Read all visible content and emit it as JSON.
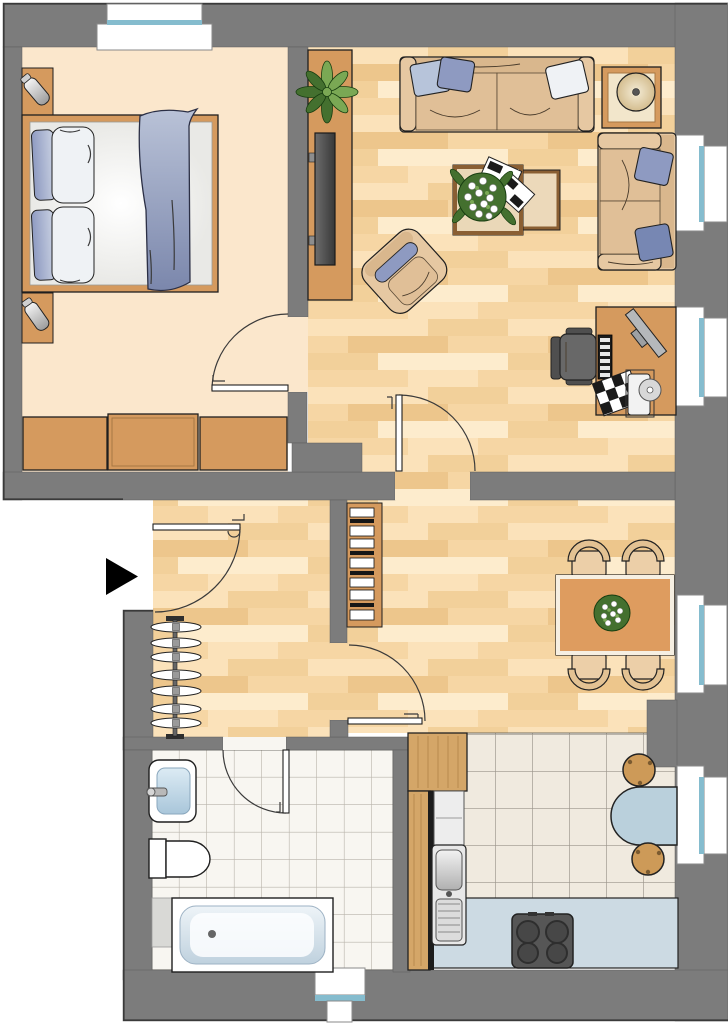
{
  "plan": {
    "type": "apartment-floor-plan",
    "rooms": [
      {
        "id": "bedroom",
        "position": "top-left",
        "floor": "plain-cream",
        "furniture": [
          "double-bed",
          "blue-pillows",
          "white-pillows",
          "blue-blanket",
          "nightstand-top",
          "nightstand-bottom",
          "table-lamp-top",
          "table-lamp-bottom",
          "wardrobe-three-sections"
        ],
        "windows": [
          "top-wall-window"
        ],
        "doors": [
          "door-to-hallway-corridor"
        ]
      },
      {
        "id": "living-room",
        "position": "top-right",
        "floor": "wood-parquet",
        "furniture": [
          "sideboard",
          "potted-plant",
          "tv",
          "three-seat-sofa",
          "sofa-pillows",
          "side-table-with-lamp",
          "two-seat-sofa",
          "coffee-table-pair",
          "flower-bouquet",
          "magazines",
          "armchair",
          "desk",
          "monitor",
          "keyboard",
          "checkered-notebook",
          "printer-with-cd",
          "office-chair"
        ],
        "windows": [
          "right-wall-window-upper",
          "right-wall-window-lower"
        ],
        "doors": [
          "door-to-hallway"
        ]
      },
      {
        "id": "hallway",
        "position": "middle-left",
        "floor": "wood-parquet",
        "furniture": [
          "coat-rack",
          "shelf-unit"
        ],
        "doors": [
          "entrance-door",
          "door-to-kitchen-corridor"
        ]
      },
      {
        "id": "dining-area",
        "position": "middle-right",
        "floor": "wood-parquet",
        "furniture": [
          "dining-table",
          "dining-chairs-4",
          "flower-centerpiece"
        ],
        "windows": [
          "right-wall-window"
        ]
      },
      {
        "id": "bathroom",
        "position": "bottom-left",
        "floor": "white-tiles",
        "furniture": [
          "washbasin",
          "faucet",
          "toilet",
          "bathtub"
        ],
        "windows": [
          "bottom-wall-window"
        ],
        "doors": [
          "bathroom-door"
        ]
      },
      {
        "id": "kitchen",
        "position": "bottom-right",
        "floor": "cream-tiles",
        "furniture": [
          "tall-cabinet",
          "counter-run",
          "double-sink",
          "lower-counter",
          "stove-four-burners",
          "wall-mounted-table",
          "stool-top",
          "stool-bottom"
        ],
        "windows": [
          "right-wall-window"
        ]
      }
    ],
    "doors_total": 5,
    "windows_total": 6,
    "entrance": {
      "marker": "black-arrow-icon",
      "side": "left",
      "direction": "pointing-right"
    }
  },
  "colors": {
    "page": "#ffffff",
    "wall": "#7c7c7c",
    "wall-line": "#3a3a3a",
    "outline": "#1f1f1f",
    "bedroom-floor": "#fbe7cc",
    "parquet-base": "#f6d6a4",
    "parquet-a": "#fbe2ba",
    "parquet-b": "#fdeccd",
    "parquet-c": "#f2d09a",
    "parquet-d": "#edc68c",
    "bath-tile": "#f8f6f1",
    "bath-grout": "#b9b4ab",
    "kitchen-tile": "#f0eadf",
    "kitchen-grout": "#9b958a",
    "wood": "#d59a5e",
    "wood-dark": "#8a5f33",
    "cabinet": "#d4a668",
    "uph": "#e6c8a2",
    "uph-dark": "#d9b78d",
    "uph-mid": "#e0bf97",
    "pillow-light": "#b7c4da",
    "pillow-mid": "#8e9ac1",
    "pillow-dark": "#7787b3",
    "pillow-white": "#eff2f5",
    "blanket": "#7b87ac",
    "glass": "#85bcce",
    "counter-blue": "#ccdae3",
    "table-blue": "#bad0dc",
    "stool": "#cd9a58",
    "stove": "#565656",
    "burner": "#474747",
    "chair-gray": "#686868",
    "chair-gray-dark": "#4f4f4f",
    "plant-green": "#44702f",
    "plant-green-light": "#7aa854",
    "dining-table": "#de9c5f",
    "chair-tan": "#eccfa8",
    "chair-back-tan": "#e3c293",
    "arrow": "#000000"
  }
}
